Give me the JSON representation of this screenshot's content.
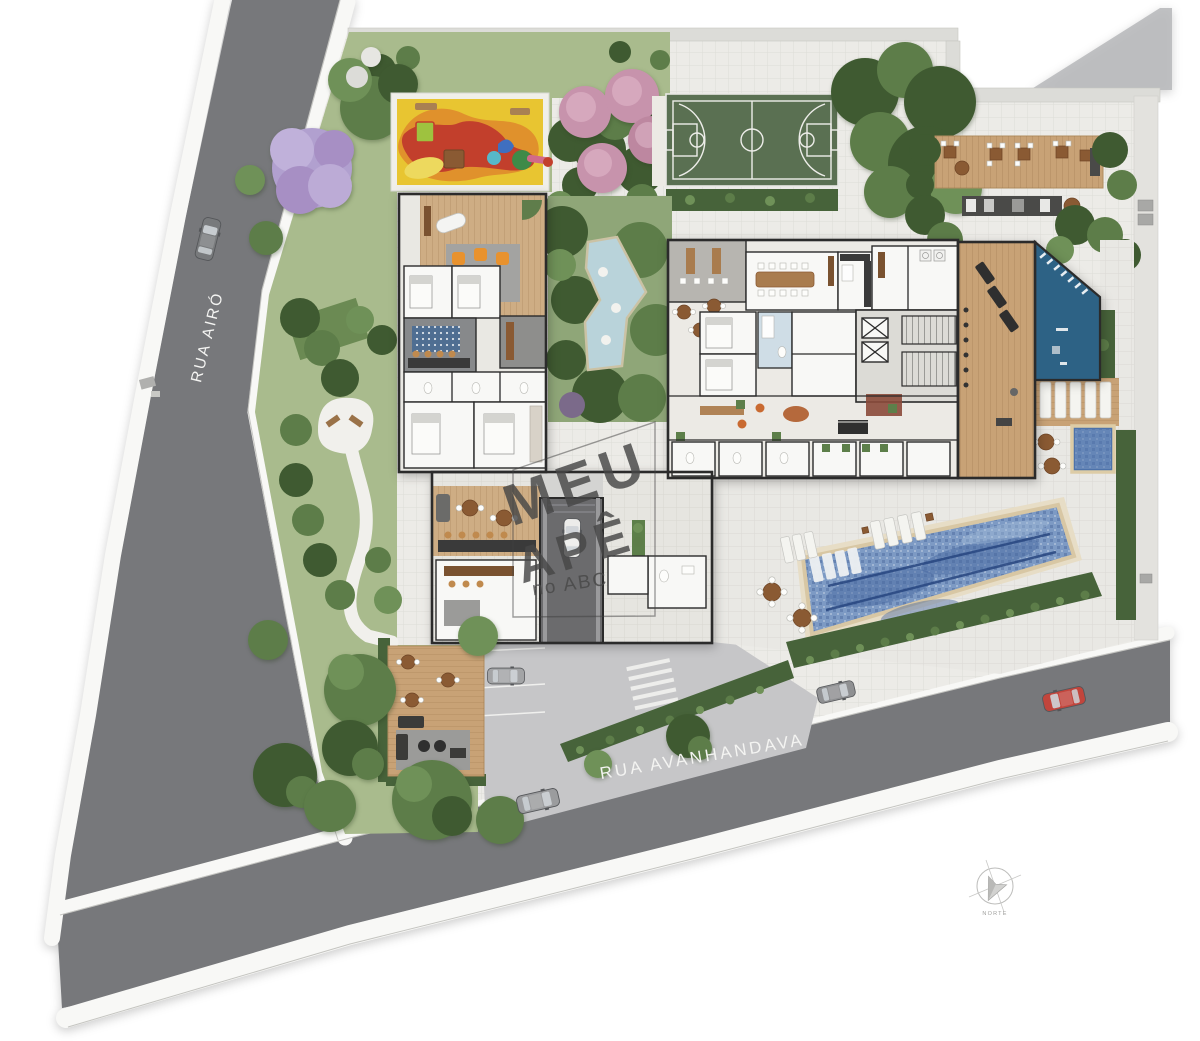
{
  "streets": {
    "left": {
      "name": "RUA AIRÓ"
    },
    "bottom": {
      "name": "RUA AVANHANDAVA"
    }
  },
  "watermark": {
    "line1": "MEU",
    "line2": "APÊ",
    "line3": "no ABC"
  },
  "compass": {
    "label": "NORTE"
  },
  "palette": {
    "road_gray": "#77787b",
    "sidewalk_white": "#f8f8f6",
    "lot_paving": "#ecebe7",
    "lawn_green": "#a9bb8d",
    "pond_garden_green": "#8fa678",
    "hedge_dark": "#47633a",
    "court_green": "#5a7052",
    "pond_blue": "#b9d3da",
    "pool_blue": "#7d9ac4",
    "pool_lane": "#27457f",
    "spa_blue": "#4d72aa",
    "deck_wood": "#c8a276",
    "interior_wood": "#cead84",
    "blue_room": "#2d6285",
    "playground_yellow": "#e8c531",
    "playground_orange": "#e0912c",
    "playground_red": "#c23f2c",
    "accent_orange": "#e8922e",
    "car_red": "#c2453c",
    "watermark_gray": "#474747",
    "street_text": "#f4f4f2"
  },
  "features": [
    "street-rua-airo",
    "street-rua-avanhandava",
    "lawn-garden",
    "winding-path-plaza",
    "playground",
    "flowering-trees",
    "sports-court",
    "barbecue-deck",
    "outdoor-kitchen",
    "ornamental-pond",
    "residential-building",
    "lobby",
    "elevator-core",
    "gym",
    "climbing-room",
    "spa-plunge-pool",
    "lap-pool",
    "sun-loungers",
    "pool-hedge",
    "driveway",
    "garage-ramp",
    "ground-deck-lounge",
    "compass-rose",
    "watermark"
  ]
}
